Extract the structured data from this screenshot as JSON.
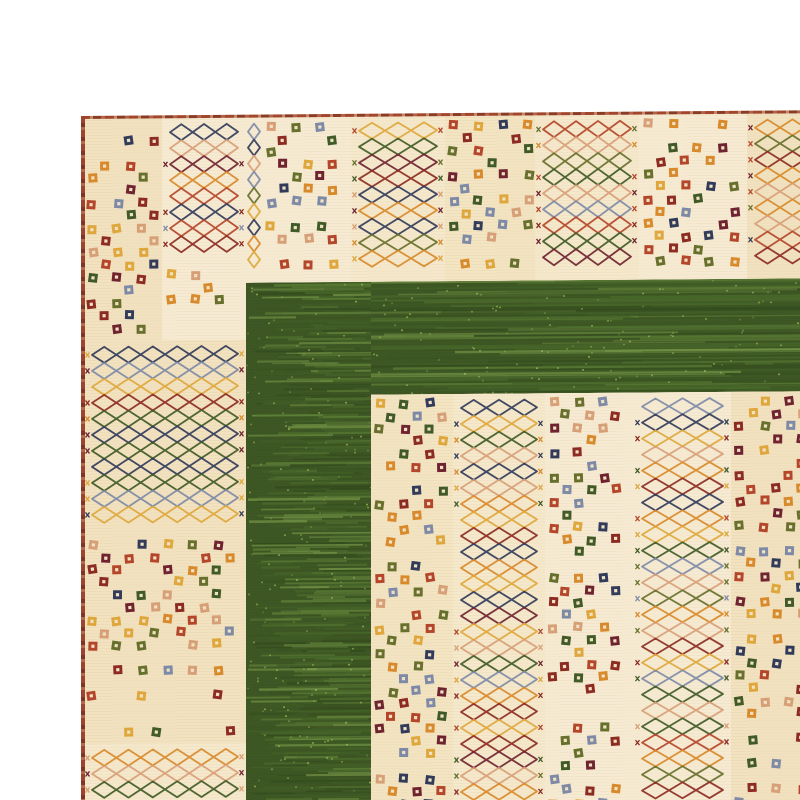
{
  "scene": {
    "type": "photograph",
    "subject": "Close-up of the corner of a hand-knotted Gabbeh-style wool rug on a white background",
    "background_color": "#ffffff",
    "description": "Cream rug with patchwork vertical stripes of small multicolored checker-dot squares alternating with multicolored diamond trellis lattice stripes; a wide mottled dark-green band forms an L-shaped inner frame around the inner field; thin red-brown selvage runs along the top and left edges; rug is slightly skewed in the frame and runs off the right and bottom edges."
  },
  "rug": {
    "base_color": "#f4e7c9",
    "base_tints": [
      "#f5e8cb",
      "#f3e4c2",
      "#f6ebd2",
      "#f2e2bf"
    ],
    "selvage": {
      "colors": [
        "#9c4430",
        "#7e3526",
        "#b26a4a"
      ],
      "top_height": 3,
      "left_width": 4
    },
    "green_band": {
      "base": "#3c5623",
      "streaks": [
        "#2c431a",
        "#35511f",
        "#43652a",
        "#527a31",
        "#6d9440",
        "#86aa52"
      ],
      "fleck": "#a9c25e",
      "bands": [
        {
          "x": 165,
          "y": 168,
          "w": 567,
          "h": 113
        },
        {
          "x": 165,
          "y": 168,
          "w": 125,
          "h": 530
        }
      ]
    },
    "motifs": {
      "dot_palette": [
        "#303a5a",
        "#6e2230",
        "#8c2a22",
        "#b5452a",
        "#d98a2b",
        "#e0a83c",
        "#66702c",
        "#3f5a26",
        "#d8a078",
        "#7d8aa8"
      ],
      "dot_center": "#f1e3c4",
      "lattice_palette": [
        "#8c2a22",
        "#303a5a",
        "#d98a2b",
        "#66702c",
        "#b5452a",
        "#d8a078",
        "#3f5a26",
        "#7d8aa8",
        "#6e2230",
        "#e0a83c"
      ],
      "dot_size": 9,
      "dot_cell": 12.5,
      "lattice_cell_w": 22,
      "lattice_cell_h": 16
    },
    "blocks": [
      {
        "x": 3,
        "y": 3,
        "w": 78,
        "h": 222,
        "pattern": "dots"
      },
      {
        "x": 81,
        "y": 3,
        "w": 84,
        "h": 147,
        "pattern": "lattice"
      },
      {
        "x": 81,
        "y": 150,
        "w": 84,
        "h": 75,
        "pattern": "dots"
      },
      {
        "x": 3,
        "y": 225,
        "w": 162,
        "h": 195,
        "pattern": "lattice"
      },
      {
        "x": 3,
        "y": 420,
        "w": 162,
        "h": 208,
        "pattern": "dots"
      },
      {
        "x": 3,
        "y": 628,
        "w": 162,
        "h": 70,
        "pattern": "lattice"
      },
      {
        "x": 165,
        "y": 3,
        "w": 16,
        "h": 165,
        "pattern": "lattice"
      },
      {
        "x": 181,
        "y": 3,
        "w": 89,
        "h": 165,
        "pattern": "dots"
      },
      {
        "x": 270,
        "y": 3,
        "w": 94,
        "h": 165,
        "pattern": "lattice"
      },
      {
        "x": 364,
        "y": 3,
        "w": 90,
        "h": 165,
        "pattern": "dots"
      },
      {
        "x": 454,
        "y": 3,
        "w": 104,
        "h": 165,
        "pattern": "lattice"
      },
      {
        "x": 558,
        "y": 3,
        "w": 108,
        "h": 165,
        "pattern": "dots"
      },
      {
        "x": 666,
        "y": 3,
        "w": 66,
        "h": 165,
        "pattern": "lattice"
      },
      {
        "x": 290,
        "y": 281,
        "w": 82,
        "h": 417,
        "pattern": "dots"
      },
      {
        "x": 372,
        "y": 281,
        "w": 92,
        "h": 417,
        "pattern": "lattice"
      },
      {
        "x": 464,
        "y": 281,
        "w": 89,
        "h": 417,
        "pattern": "dots"
      },
      {
        "x": 553,
        "y": 281,
        "w": 97,
        "h": 417,
        "pattern": "lattice"
      },
      {
        "x": 650,
        "y": 281,
        "w": 82,
        "h": 417,
        "pattern": "dots"
      }
    ]
  }
}
